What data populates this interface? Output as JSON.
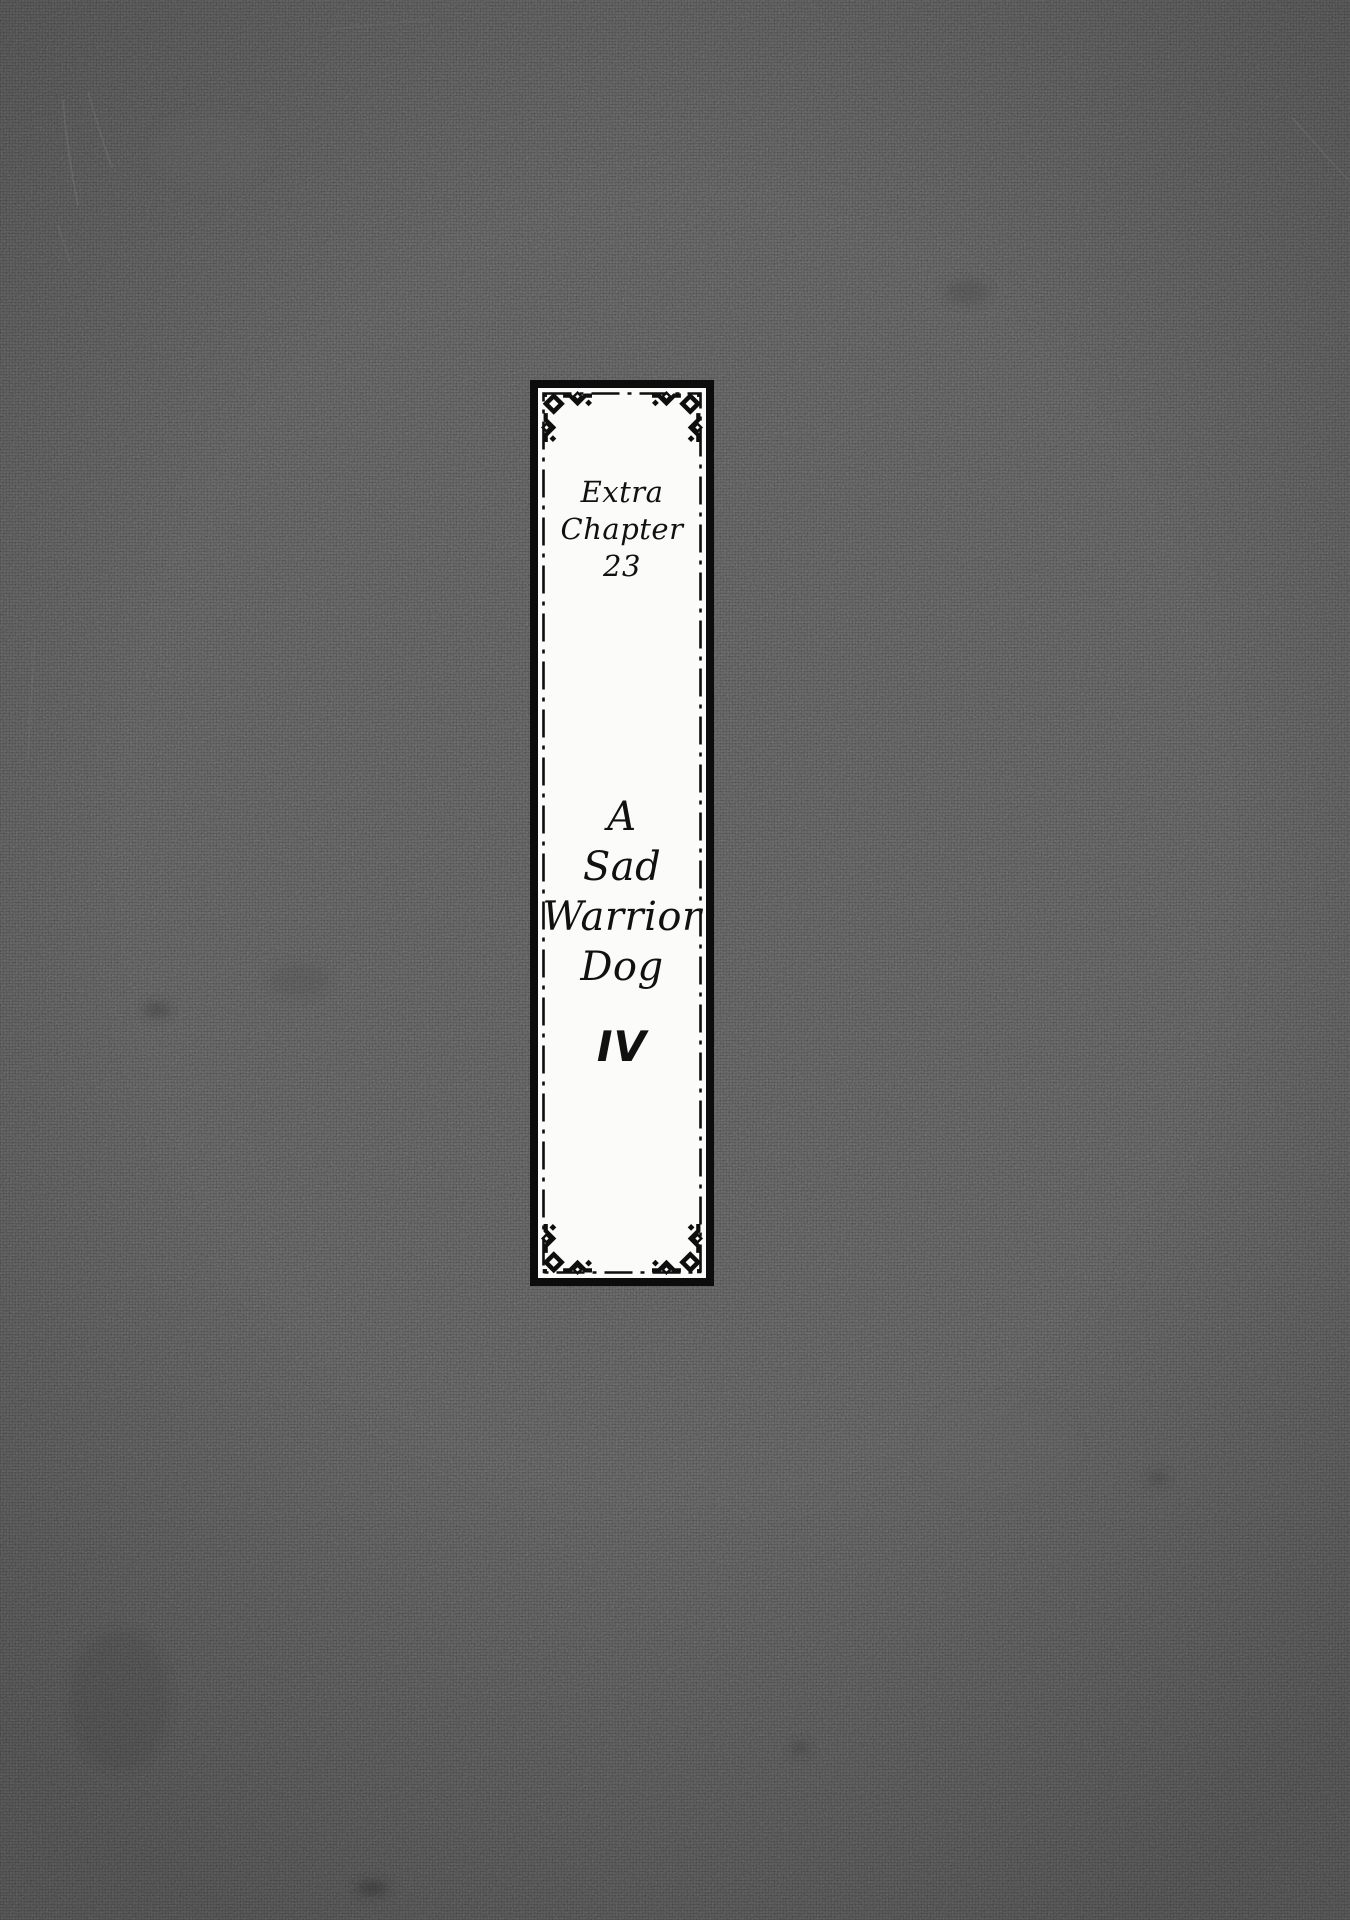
{
  "title_panel": {
    "chapter_label_line1": "Extra",
    "chapter_label_line2": "Chapter 23",
    "title_lines": [
      "A",
      "Sad",
      "Warrior",
      "Dog"
    ],
    "volume_numeral": "IV"
  },
  "colors": {
    "background_gray": "#585858",
    "panel_paper_white": "#fbfbfa",
    "ink_black": "#0c0c0c"
  }
}
